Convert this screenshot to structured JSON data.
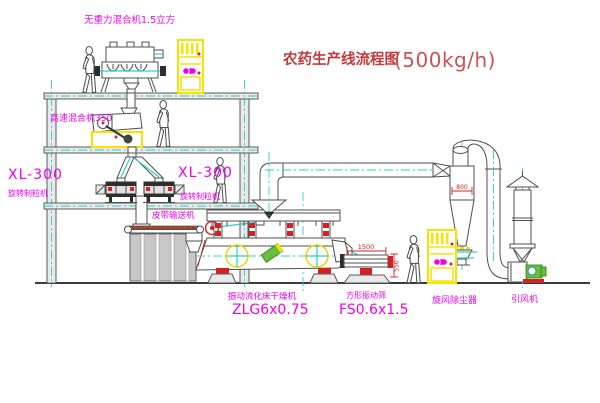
{
  "title": {
    "text": "农药生产线流程图",
    "capacity": "(500kg/h)"
  },
  "labels": {
    "gravity_free_mixer": "无重力混合机1.5立方",
    "high_speed_mixer": "高速混合机350",
    "granulator_model_left": "XL-300",
    "granulator_name_left": "旋转制粒机",
    "granulator_model_right": "XL-300",
    "granulator_name_right": "旋转制粒机",
    "belt_conveyor": "皮带输送机",
    "dryer_name": "振动流化床干燥机",
    "dryer_model": "ZLG6x0.75",
    "screen_name": "方形振动筛",
    "screen_model": "FS0.6x1.5",
    "cyclone": "旋风除尘器",
    "fan": "引风机"
  },
  "dimensions": {
    "screen_length": "1500",
    "screen_height": "550",
    "cyclone_body": "800"
  },
  "colors": {
    "label_magenta": "#f000f0",
    "title_red": "#c23b3b",
    "line_grey": "#4f4f4f",
    "centerline_cyan": "#27d1d1",
    "highlight_yellow": "#f5e400",
    "accent_red": "#d42020",
    "accent_green": "#6abf3a"
  }
}
